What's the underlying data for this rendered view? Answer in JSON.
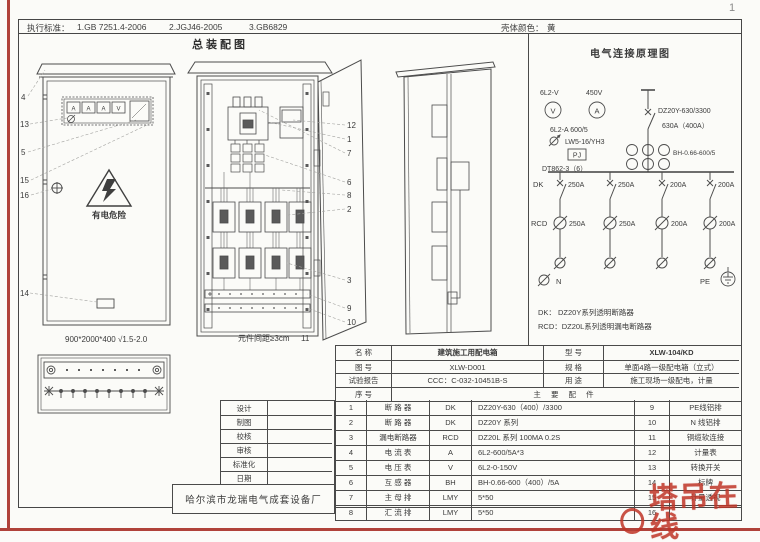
{
  "page_number": "1",
  "header": {
    "standards_label": "执行标准：",
    "standard_1": "1.GB 7251.4-2006",
    "standard_2": "2.JGJ46-2005",
    "standard_3": "3.GB6829",
    "shell_color_label": "壳体颜色：",
    "shell_color_value": "黄"
  },
  "assembly": {
    "title": "总装配图",
    "front_view": {
      "callouts": [
        "4",
        "13",
        "5",
        "15",
        "16",
        "14"
      ],
      "panel_meters": [
        "A",
        "A",
        "A",
        "V"
      ],
      "warning": "有电危险",
      "dimension": "900*2000*400  √1.5-2.0"
    },
    "internal_view": {
      "callouts": [
        "12",
        "1",
        "7",
        "6",
        "8",
        "2",
        "3",
        "9",
        "10"
      ],
      "note": "元件间距≥3cm",
      "note_callout": "11"
    }
  },
  "schematic": {
    "title": "电气连接原理图",
    "voltmeter_type": "6L2-V",
    "voltage": "450V",
    "voltmeter_symbol": "V",
    "ammeter_symbol": "A",
    "ammeter_type": "6L2-A 600/5",
    "changeover_switch": "LW5-16/YH3",
    "pj": "PJ",
    "kwh_meter": "DT862-3（6）",
    "main_breaker": "DZ20Y-630/3300",
    "main_breaker_rating": "630A（400A）",
    "ct": "BH-0.66-600/5",
    "dk_label": "DK",
    "rcd_label": "RCD",
    "dk_ratings": [
      "250A",
      "250A",
      "200A",
      "200A"
    ],
    "rcd_ratings": [
      "250A",
      "250A",
      "200A",
      "200A"
    ],
    "n_label": "N",
    "pe_label": "PE",
    "legend_dk": "DK：  DZ20Y系列透明断路器",
    "legend_rcd": "RCD：DZ20L系列透明漏电断路器"
  },
  "info_table": {
    "name_label": "名    称",
    "name_value": "建筑施工用配电箱",
    "model_label": "型    号",
    "model_value": "XLW-104/KD",
    "drawing_label": "图    号",
    "drawing_value": "XLW-D001",
    "spec_label": "规    格",
    "spec_value": "单面4路一级配电箱（立式）",
    "report_label": "试验报告",
    "report_value": "CCC：C-032-10451B-S",
    "use_label": "用    途",
    "use_value": "施工现场一级配电，计量",
    "serial_label": "序    号",
    "parts_label": "主  要  配  件"
  },
  "parts": {
    "rows": [
      {
        "no": "1",
        "name": "断 路 器",
        "code": "DK",
        "spec": "DZ20Y-630（400）/3300",
        "no2": "9",
        "name2": "PE线铝排"
      },
      {
        "no": "2",
        "name": "断 路 器",
        "code": "DK",
        "spec": "DZ20Y 系列",
        "no2": "10",
        "name2": "N 线铝排"
      },
      {
        "no": "3",
        "name": "漏电断路器",
        "code": "RCD",
        "spec": "DZ20L 系列  100MA 0.2S",
        "no2": "11",
        "name2": "铜缆软连接"
      },
      {
        "no": "4",
        "name": "电 流 表",
        "code": "A",
        "spec": "6L2-600/5A*3",
        "no2": "12",
        "name2": "计量表"
      },
      {
        "no": "5",
        "name": "电 压 表",
        "code": "V",
        "spec": "6L2-0-150V",
        "no2": "13",
        "name2": "转换开关"
      },
      {
        "no": "6",
        "name": "互 感 器",
        "code": "BH",
        "spec": "BH-0.66-600（400）/5A",
        "no2": "14",
        "name2": "标牌"
      },
      {
        "no": "7",
        "name": "主 母 排",
        "code": "LMY",
        "spec": "5*50",
        "no2": "15",
        "name2": "计量透视"
      },
      {
        "no": "8",
        "name": "汇 流 排",
        "code": "LMY",
        "spec": "5*50",
        "no2": "16",
        "name2": ""
      }
    ]
  },
  "title_block": {
    "rows": [
      "设计",
      "制图",
      "校核",
      "审核",
      "标准化",
      "日期"
    ],
    "manufacturer": "哈尔滨市龙瑞电气成套设备厂"
  },
  "watermark": "塔吊在线"
}
